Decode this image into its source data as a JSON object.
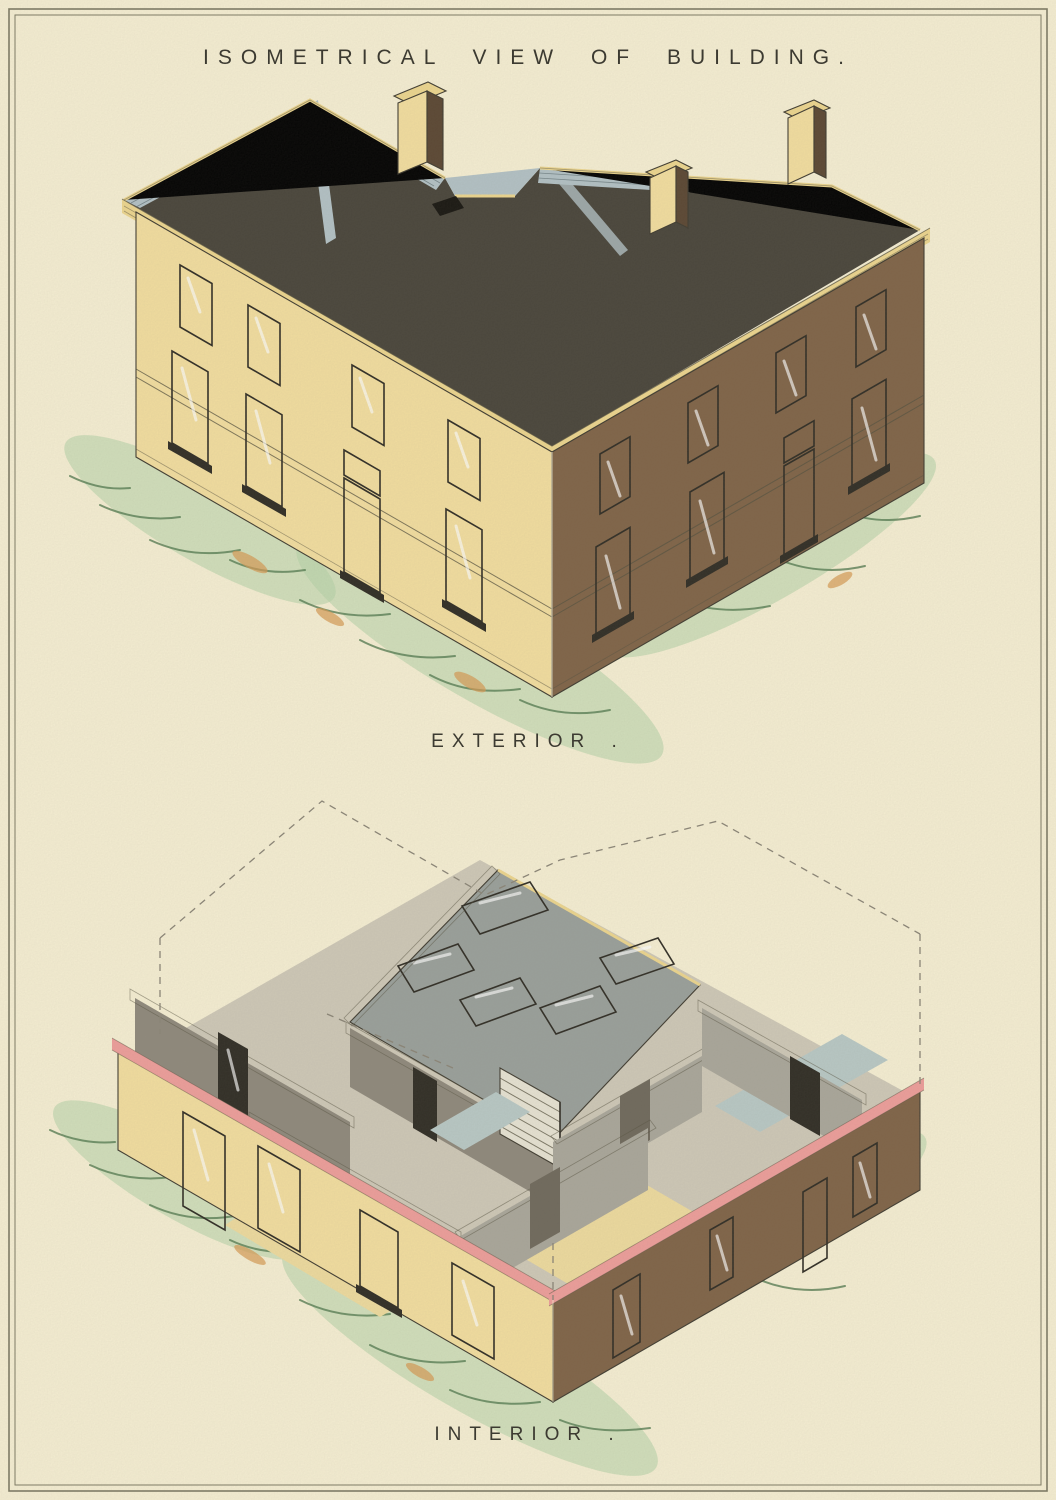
{
  "plate": {
    "title": "ISOMETRICAL VIEW OF BUILDING.",
    "figures": [
      {
        "id": "exterior",
        "label": "EXTERIOR ."
      },
      {
        "id": "interior",
        "label": "INTERIOR ."
      }
    ]
  },
  "colors": {
    "paper": "#f7f0d4",
    "frame": "#7d7a64",
    "ink": "#3c3a31",
    "roof_dark": "#48443a",
    "roof_light": "#b3c2c6",
    "trim_yellow": "#eed78f",
    "wall_yellow": "#f4dfa0",
    "wall_brown": "#7f6347",
    "wall_brown_dark": "#5a4632",
    "glass": "#cfe3de",
    "frame_dark": "#2f2c24",
    "coping_pink": "#ef9e9b",
    "interior_gray": "#8f897c",
    "interior_gray_light": "#aaa79b",
    "interior_gray_dark": "#6f695c",
    "interior_roof": "#9aa09b",
    "floor_yellow": "#efdc9f",
    "floor_blue": "#b9c9c6",
    "grass_light": "#b5d4a8",
    "grass_dark": "#567d52",
    "grass_orange": "#d79a52",
    "door_tan": "#d7a058",
    "dash": "#8b8577"
  }
}
